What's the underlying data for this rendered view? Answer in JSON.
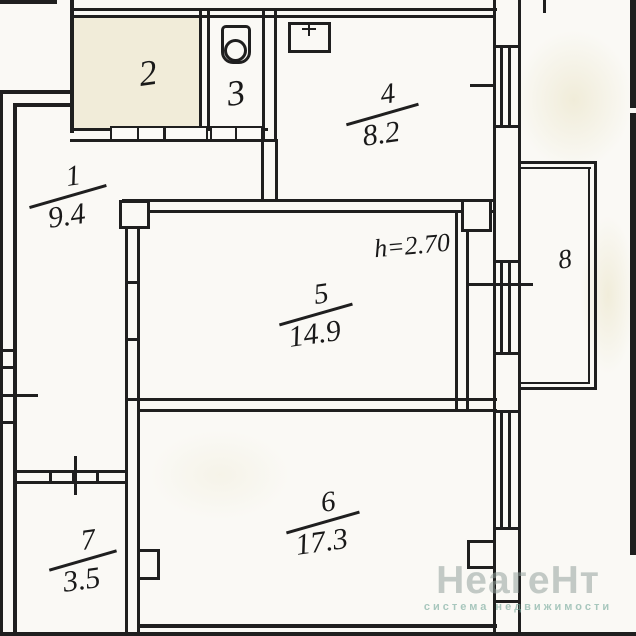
{
  "plan": {
    "annotation": "h=2.70",
    "rooms": [
      {
        "num": "1",
        "area": "9.4"
      },
      {
        "num": "2",
        "area": ""
      },
      {
        "num": "3",
        "area": ""
      },
      {
        "num": "4",
        "area": "8.2"
      },
      {
        "num": "5",
        "area": "14.9"
      },
      {
        "num": "6",
        "area": "17.3"
      },
      {
        "num": "7",
        "area": "3.5"
      },
      {
        "num": "8",
        "area": ""
      }
    ],
    "icons": {
      "sink": "sink-icon",
      "panel": "electrical-panel-icon"
    }
  },
  "watermark": {
    "title": "НеагеНт",
    "subtitle": "система недвижимости"
  },
  "colors": {
    "ink": "#1f1f1f",
    "paper": "#faf9f5",
    "aged_patch": "#e2d9af",
    "watermark_title": "#94a39c",
    "watermark_subtitle": "#76a89b"
  }
}
